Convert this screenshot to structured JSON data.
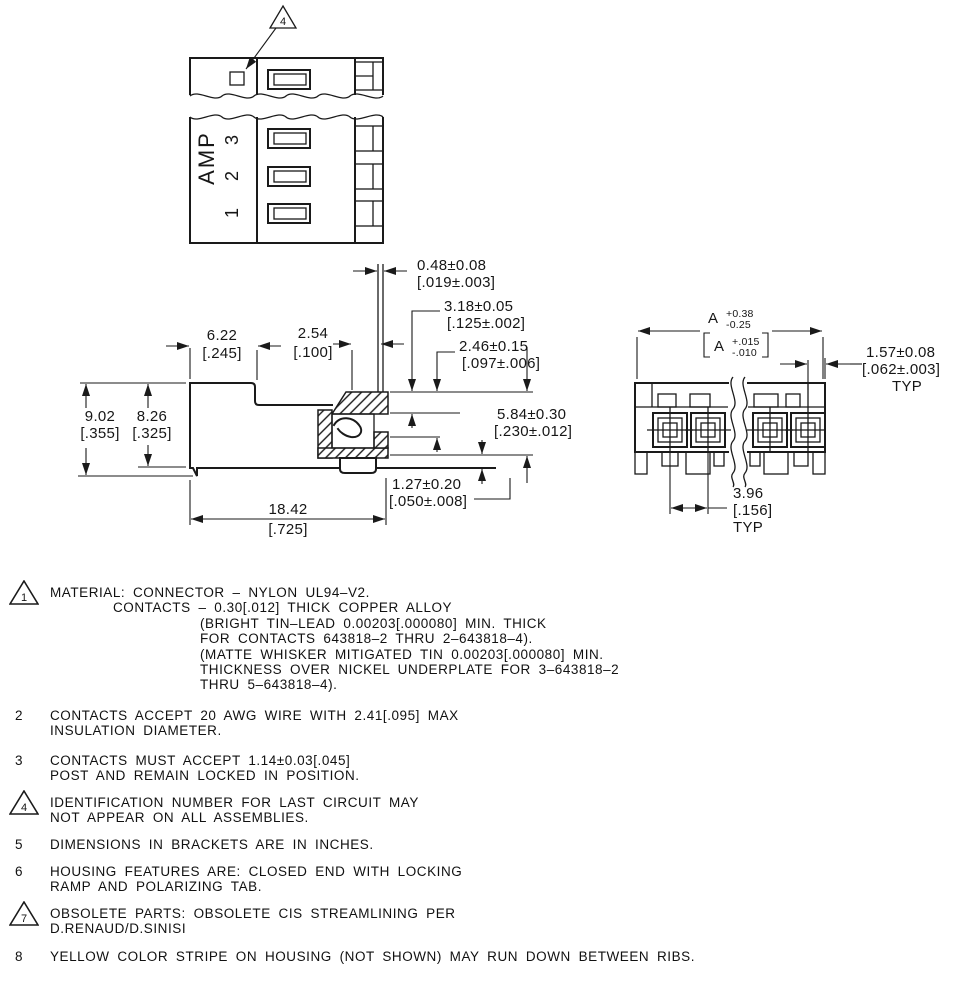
{
  "colors": {
    "ink": "#1a1a1a",
    "background": "#ffffff"
  },
  "top_view": {
    "brand": "AMP",
    "circuit_1": "1",
    "circuit_2": "2",
    "circuit_3": "3",
    "callout": "4"
  },
  "dims": {
    "post_w_mm": "0.48±0.08",
    "post_w_in": "[.019±.003]",
    "d318_mm": "3.18±0.05",
    "d318_in": "[.125±.002]",
    "d246_mm": "2.46±0.15",
    "d246_in": "[.097±.006]",
    "d584_mm": "5.84±0.30",
    "d584_in": "[.230±.012]",
    "d622_mm": "6.22",
    "d622_in": "[.245]",
    "d254_mm": "2.54",
    "d254_in": "[.100]",
    "d902_mm": "9.02",
    "d902_in": "[.355]",
    "d826_mm": "8.26",
    "d826_in": "[.325]",
    "d1842_mm": "18.42",
    "d1842_in": "[.725]",
    "d127_mm": "1.27±0.20",
    "d127_in": "[.050±.008]"
  },
  "end_view": {
    "dA_label": "A",
    "dA_plus": "+0.38",
    "dA_minus": "-0.25",
    "dA_in_label": "A",
    "dA_in_plus": "+.015",
    "dA_in_minus": "-.010",
    "d157_mm": "1.57±0.08",
    "d157_in": "[.062±.003]",
    "d157_typ": "TYP",
    "d396_mm": "3.96",
    "d396_in": "[.156]",
    "d396_typ": "TYP"
  },
  "notes": [
    {
      "flag": "1",
      "flagged": true,
      "lines": [
        "MATERIAL: CONNECTOR – NYLON UL94–V2.",
        "CONTACTS – 0.30[.012] THICK COPPER ALLOY",
        "(BRIGHT TIN–LEAD 0.00203[.000080] MIN. THICK",
        "FOR CONTACTS 643818–2 THRU 2–643818–4).",
        "(MATTE WHISKER MITIGATED TIN 0.00203[.000080] MIN.",
        "THICKNESS OVER NICKEL UNDERPLATE FOR 3–643818–2",
        "THRU 5–643818–4)."
      ]
    },
    {
      "flag": "2",
      "flagged": false,
      "lines": [
        "CONTACTS ACCEPT 20 AWG WIRE WITH 2.41[.095] MAX",
        "INSULATION DIAMETER."
      ]
    },
    {
      "flag": "3",
      "flagged": false,
      "lines": [
        "CONTACTS MUST ACCEPT 1.14±0.03[.045]",
        "POST AND REMAIN LOCKED IN POSITION."
      ]
    },
    {
      "flag": "4",
      "flagged": true,
      "lines": [
        "IDENTIFICATION NUMBER FOR LAST CIRCUIT MAY",
        "NOT APPEAR ON ALL ASSEMBLIES."
      ]
    },
    {
      "flag": "5",
      "flagged": false,
      "lines": [
        "DIMENSIONS IN BRACKETS ARE IN INCHES."
      ]
    },
    {
      "flag": "6",
      "flagged": false,
      "lines": [
        "HOUSING FEATURES ARE: CLOSED END WITH LOCKING",
        "RAMP AND POLARIZING TAB."
      ]
    },
    {
      "flag": "7",
      "flagged": true,
      "lines": [
        "OBSOLETE PARTS: OBSOLETE CIS STREAMLINING PER",
        "D.RENAUD/D.SINISI"
      ]
    },
    {
      "flag": "8",
      "flagged": false,
      "lines": [
        "YELLOW COLOR STRIPE ON HOUSING (NOT SHOWN) MAY RUN DOWN BETWEEN RIBS."
      ]
    }
  ]
}
